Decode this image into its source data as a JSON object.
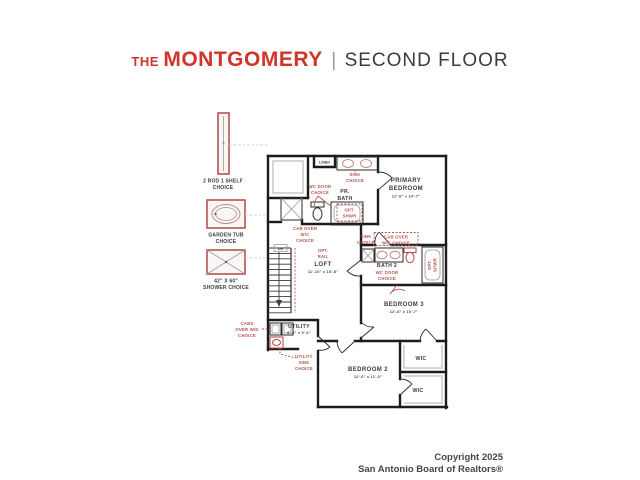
{
  "title": {
    "prefix": "THE",
    "name": "MONTGOMERY",
    "separator": "|",
    "suffix": "SECOND FLOOR"
  },
  "footer": {
    "line1": "Copyright 2025",
    "line2": "San Antonio Board of Realtors®"
  },
  "sidebar": {
    "rod_shelf_label": [
      "2 ROD 1 SHELF",
      "CHOICE"
    ],
    "garden_tub_label": [
      "GARDEN TUB",
      "CHOICE"
    ],
    "shower_label": [
      "42\" X 60\"",
      "SHOWER CHOICE"
    ]
  },
  "plan": {
    "rooms": {
      "primary_bedroom": {
        "name": [
          "PRIMARY",
          "BEDROOM"
        ],
        "dims": "12'-6\" x 14'-7\""
      },
      "pr_bath": {
        "name": [
          "PR.",
          "BATH"
        ]
      },
      "loft": {
        "name": "LOFT",
        "dims": "11'-10\" x 15'-8\""
      },
      "bath2": {
        "name": "BATH 2"
      },
      "bedroom3": {
        "name": "BEDROOM 3",
        "dims": "12'-6\" x 10'-7\""
      },
      "bedroom2": {
        "name": "BEDROOM 2",
        "dims": "12'-0\" x 11'-0\""
      },
      "utility": {
        "name": "UTILITY",
        "dims": "8'-4\" x 5'-6\""
      },
      "wic1": {
        "name": "WIC"
      },
      "wic2": {
        "name": "WIC"
      },
      "linen": {
        "name": "LINEN"
      }
    },
    "labels": {
      "dn": "DN",
      "sink_choice_bath1": [
        "SINK",
        "CHOICE"
      ],
      "wc_door_choice_bath1": [
        "WC DOOR",
        "CHOICE"
      ],
      "opt_shwr_bath1": [
        "OPT.",
        "SHWR"
      ],
      "cab_over_wc_bath1": [
        "CAB OVER",
        "W/C",
        "CHOICE"
      ],
      "opt_rail": [
        "OPT.",
        "RAIL"
      ],
      "sink_choice_bath2": [
        "SINK",
        "CHOICE"
      ],
      "cab_over_wc_bath2": [
        "CAB OVER",
        "W/C CHOICE"
      ],
      "wc_door_choice_bath2": [
        "WC DOOR",
        "CHOICE"
      ],
      "opt_shwr_bath2": [
        "OPT.",
        "SHWR"
      ],
      "cabs_over_wd": [
        "CABS",
        "OVER W/D",
        "CHOICE"
      ],
      "utility_sink": [
        "UTILITY",
        "SINK",
        "CHOICE"
      ]
    }
  },
  "colors": {
    "brand_red": "#d2342b",
    "choice_red": "#b5544e",
    "wall": "#1c1c1c"
  }
}
